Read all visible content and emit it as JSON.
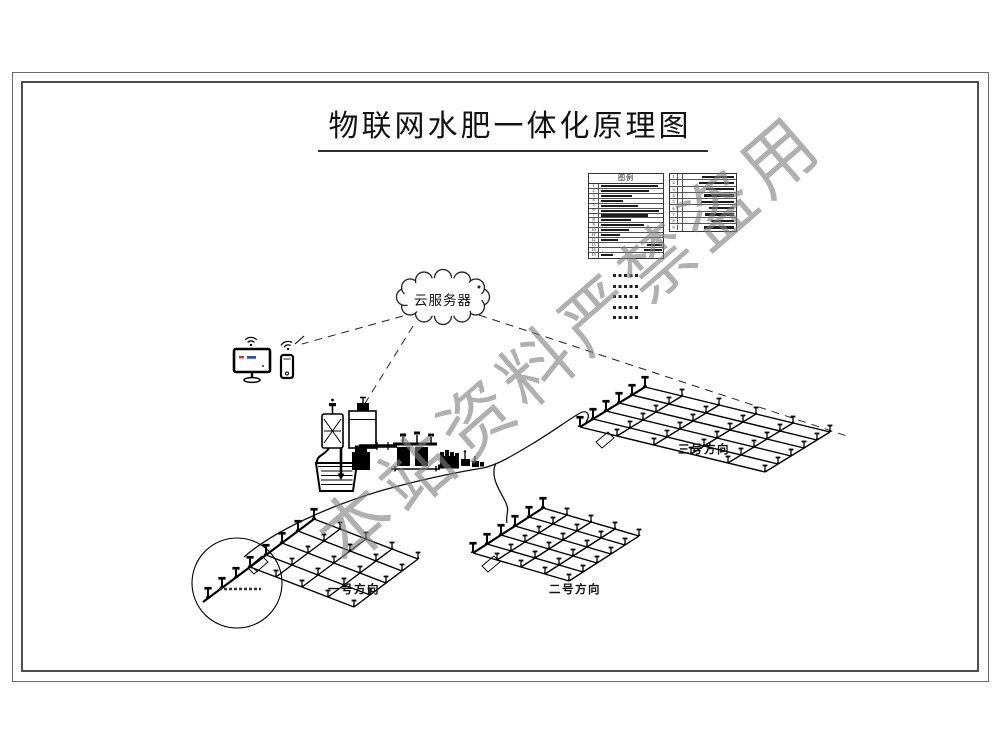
{
  "drawing": {
    "title": "物联网水肥一体化原理图",
    "watermark": "本站资料严禁盗用",
    "cloud_label": "云服务器",
    "legend_header": "图例",
    "field_labels": [
      "一号方向",
      "二号方向",
      "三号方向"
    ],
    "legend_left_nums": [
      "1",
      "2",
      "3",
      "4",
      "5",
      "6",
      "7",
      "8",
      "9",
      "10",
      "11",
      "12",
      "13",
      "14",
      "15"
    ],
    "legend_right_nums": [
      "1",
      "2",
      "3",
      "4",
      "5",
      "6",
      "7",
      "8",
      "9"
    ],
    "colors": {
      "line": "#000000",
      "frame": "#4e4e4e",
      "watermark": "#808080",
      "screen_red": "#b04030",
      "screen_blue": "#2a52b0"
    }
  }
}
